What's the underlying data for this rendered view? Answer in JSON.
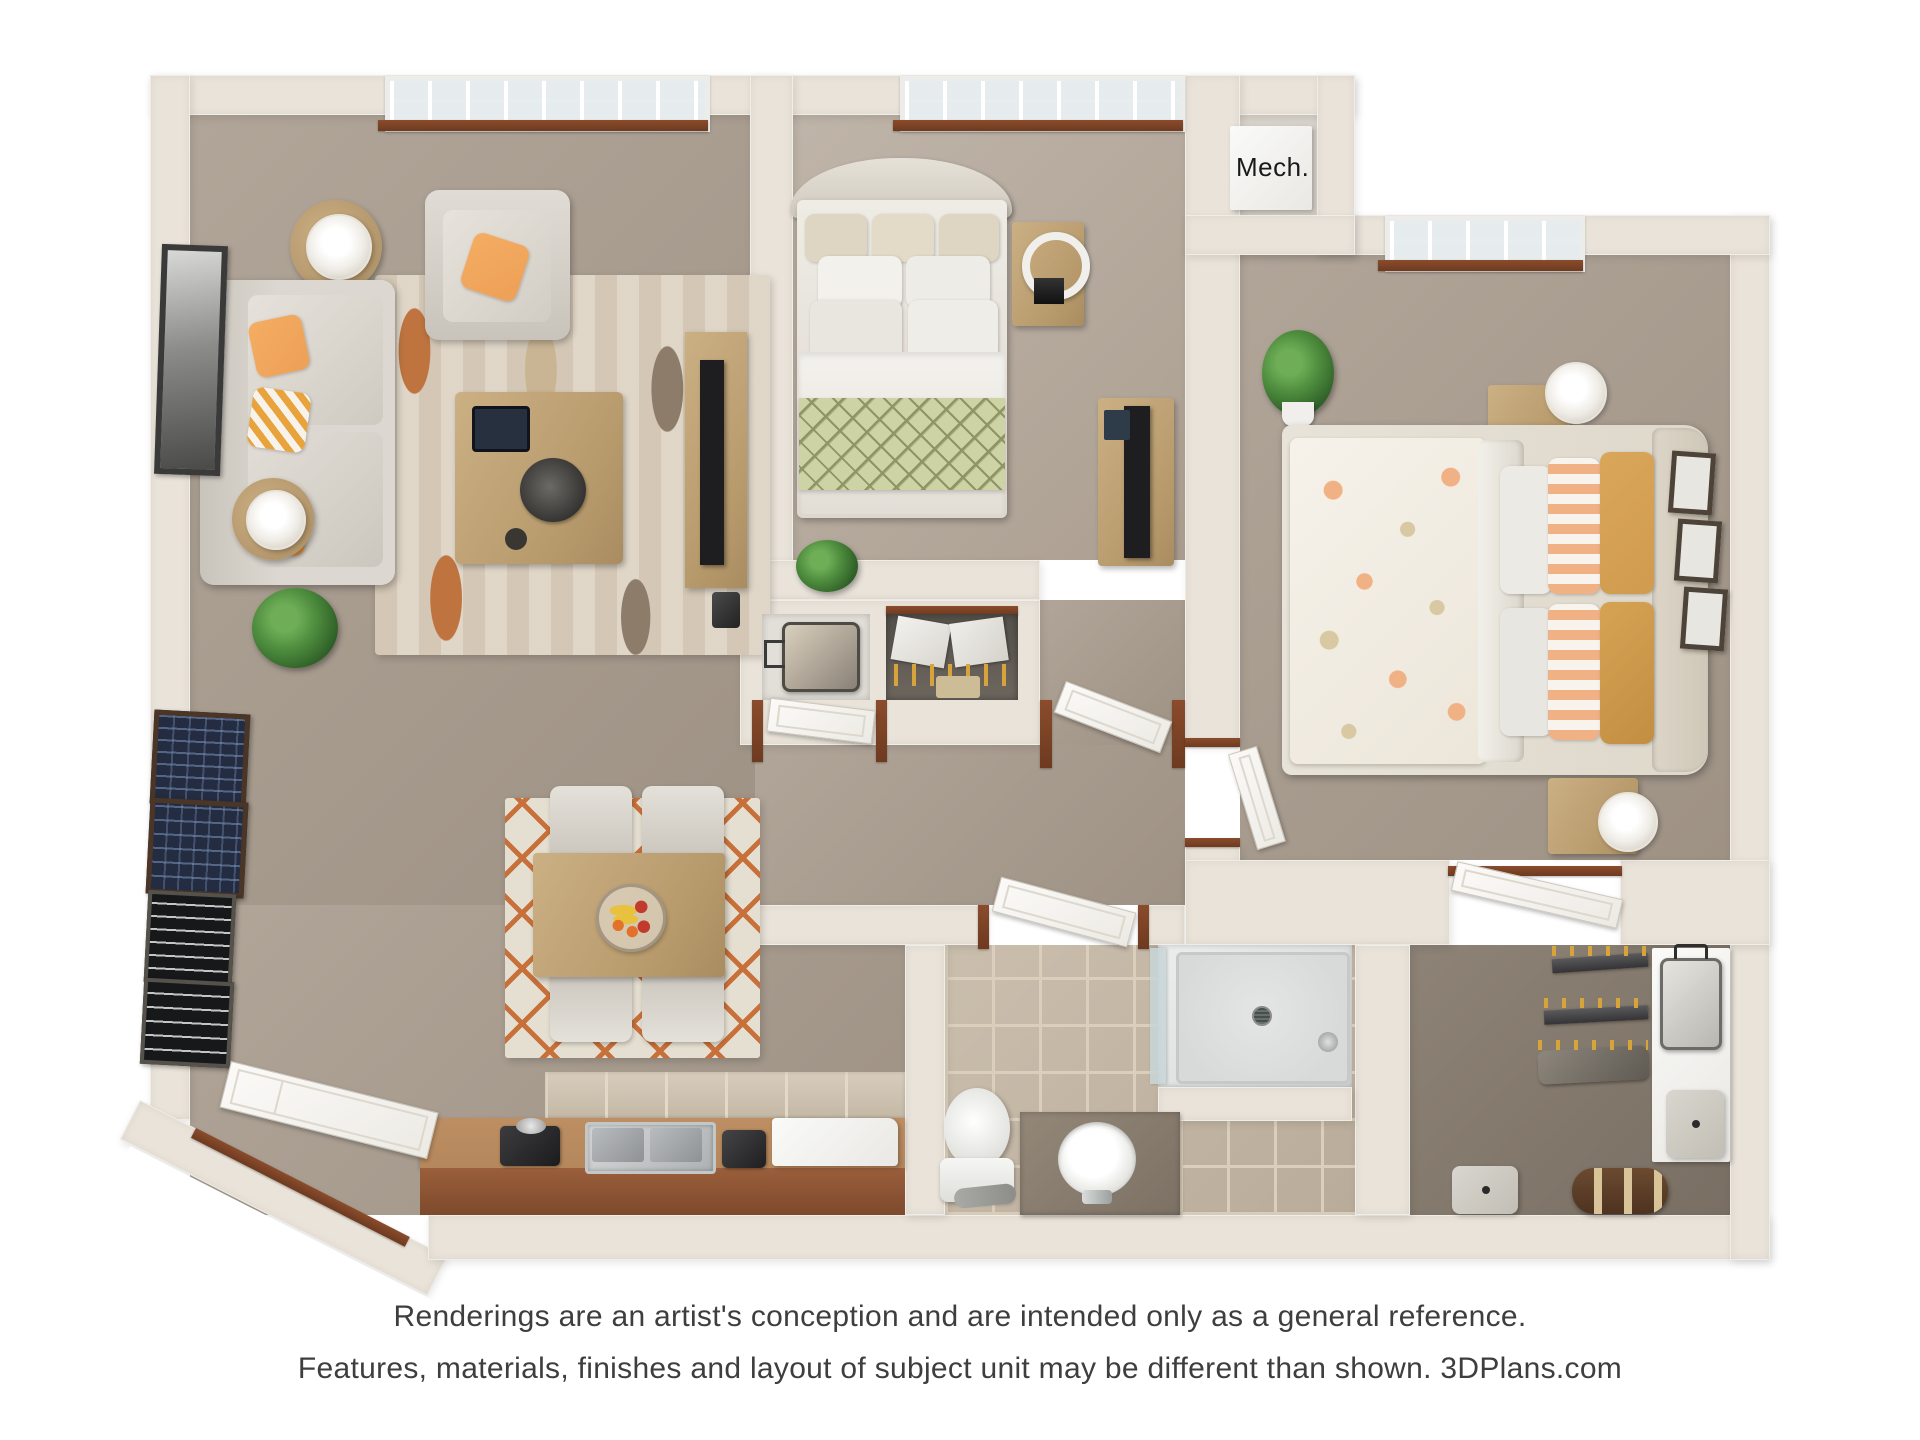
{
  "labels": {
    "mech": "Mech."
  },
  "disclaimer": {
    "line1": "Renderings are an artist's conception and are intended only as a general reference.",
    "line2": "Features, materials, finishes and layout of subject unit may be different than shown. 3DPlans.com"
  },
  "rooms": [
    "living-room",
    "dining-area",
    "kitchen",
    "bedroom-1",
    "bedroom-2",
    "bathroom",
    "walk-in-closet",
    "mechanical-closet",
    "hallway",
    "entry"
  ],
  "colors": {
    "wall": "#e9e3d9",
    "carpet": "#a89b8d",
    "carpet-light": "#b3a698",
    "carpet-dark": "#877b6e",
    "trim-wood": "#7c4427",
    "counter-top": "#b5875c",
    "counter-front": "#9a5f3c",
    "tile-bath": "#c3b5a2",
    "tile-grout": "#dbcfbc",
    "tile-kitchen": "#cfc2ae",
    "sofa": "#d8d4cd",
    "accent-orange": "#eda057",
    "accent-mustard": "#d09b4e",
    "stripe-peach": "#f0b184",
    "throw-green": "#cdd3a4",
    "throw-line": "#8f9465",
    "rug-base": "#dcd2c2",
    "rug-orange": "#bf7440",
    "rug-brown": "#8d7c6a",
    "dining-rug": "#e5dfd2",
    "dining-lattice": "#c8703a",
    "tv-black": "#1e1e20",
    "fixture-white": "#f4f3f0",
    "shower-pan": "#d8dad9",
    "glass": "#c8d6d8",
    "poster-navy": "#232c41",
    "poster-blue": "#7e96bd",
    "sign-black": "#17181a",
    "hanger": "#d7a43c",
    "fruit-banana": "#e8c13f",
    "fruit-orange": "#e2712a",
    "fruit-red": "#c03b2e",
    "text": "#3e3e3e",
    "mech-text": "#1a1a1a"
  }
}
